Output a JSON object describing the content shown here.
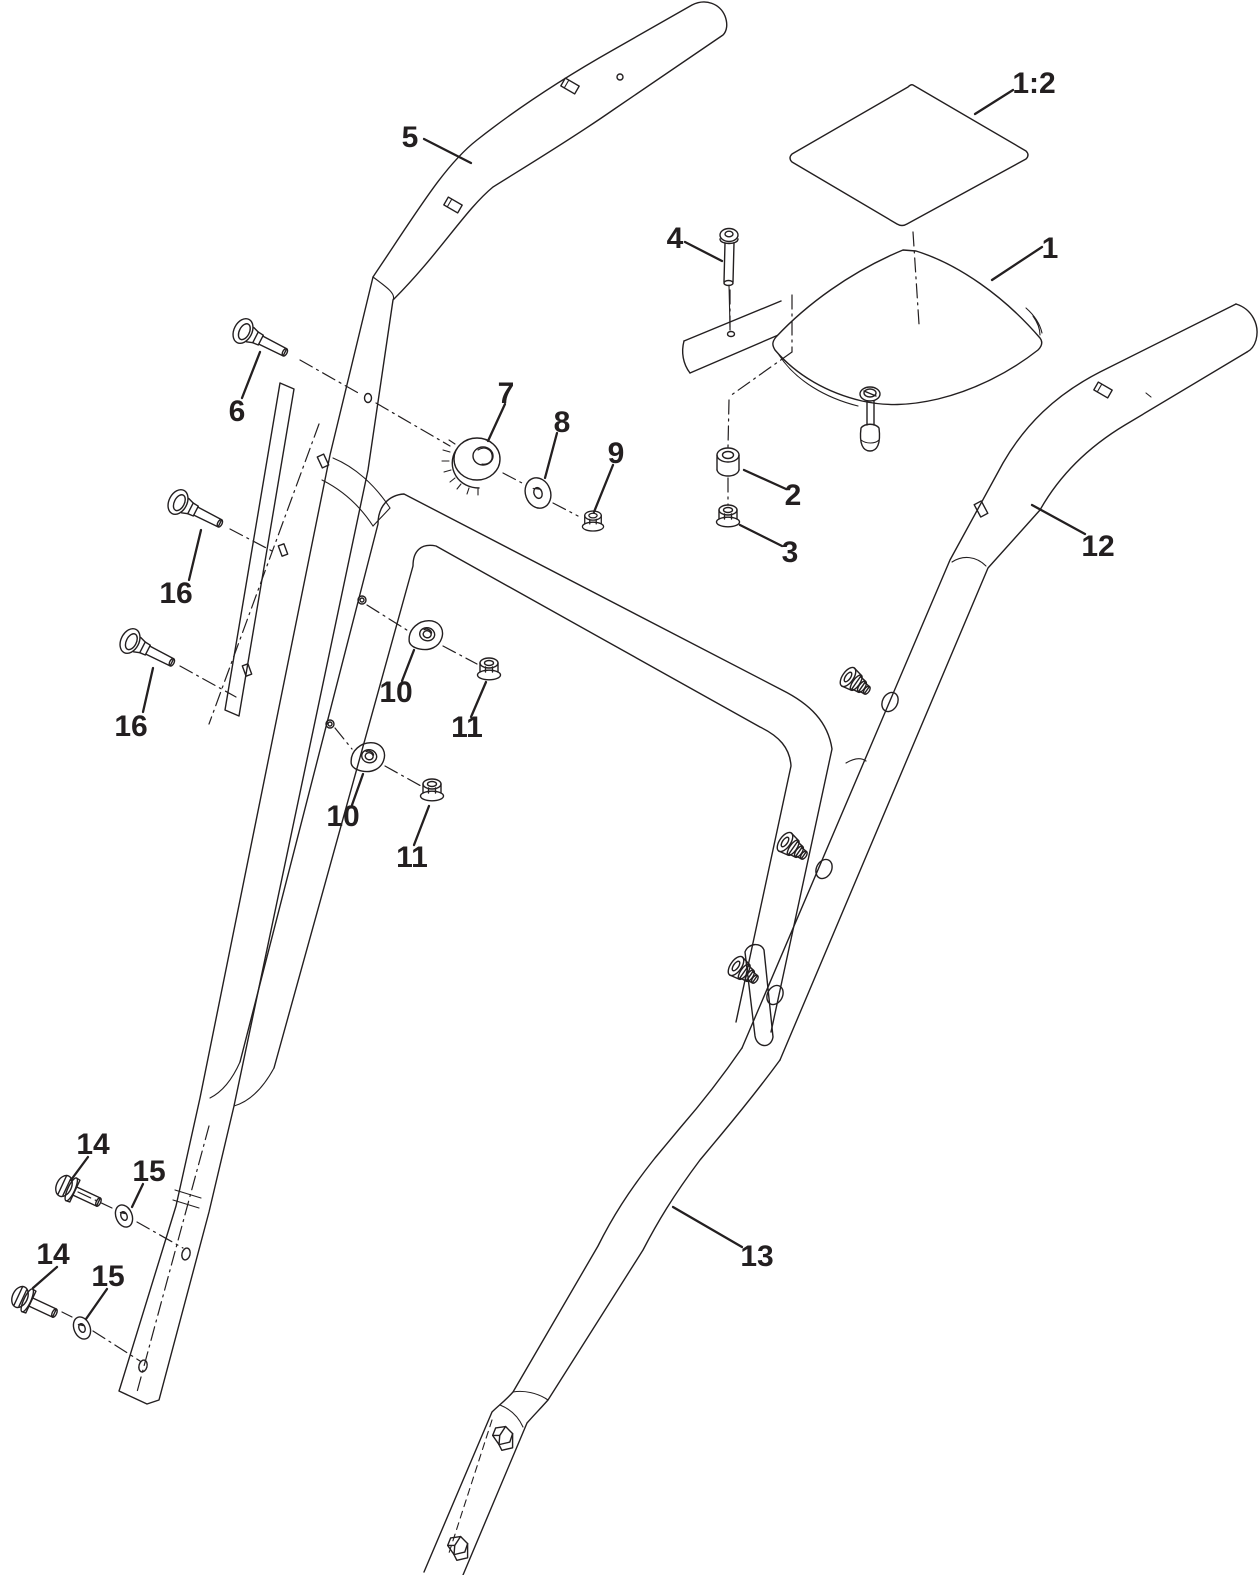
{
  "diagram": {
    "type": "exploded-parts-diagram",
    "background_color": "#ffffff",
    "line_color": "#231f20",
    "callouts": [
      {
        "part": "1:2",
        "label": "1:2"
      },
      {
        "part": "1",
        "label": "1"
      },
      {
        "part": "2",
        "label": "2"
      },
      {
        "part": "3",
        "label": "3"
      },
      {
        "part": "4",
        "label": "4"
      },
      {
        "part": "5",
        "label": "5"
      },
      {
        "part": "6",
        "label": "6"
      },
      {
        "part": "7",
        "label": "7"
      },
      {
        "part": "8",
        "label": "8"
      },
      {
        "part": "9",
        "label": "9"
      },
      {
        "part": "10",
        "label": "10",
        "instance": "upper"
      },
      {
        "part": "11",
        "label": "11",
        "instance": "upper"
      },
      {
        "part": "10",
        "label": "10",
        "instance": "lower"
      },
      {
        "part": "11",
        "label": "11",
        "instance": "lower"
      },
      {
        "part": "12",
        "label": "12"
      },
      {
        "part": "13",
        "label": "13"
      },
      {
        "part": "14",
        "label": "14",
        "instance": "upper"
      },
      {
        "part": "15",
        "label": "15",
        "instance": "upper"
      },
      {
        "part": "14",
        "label": "14",
        "instance": "lower"
      },
      {
        "part": "15",
        "label": "15",
        "instance": "lower"
      },
      {
        "part": "16",
        "label": "16",
        "instance": "upper"
      },
      {
        "part": "16",
        "label": "16",
        "instance": "lower"
      }
    ]
  }
}
